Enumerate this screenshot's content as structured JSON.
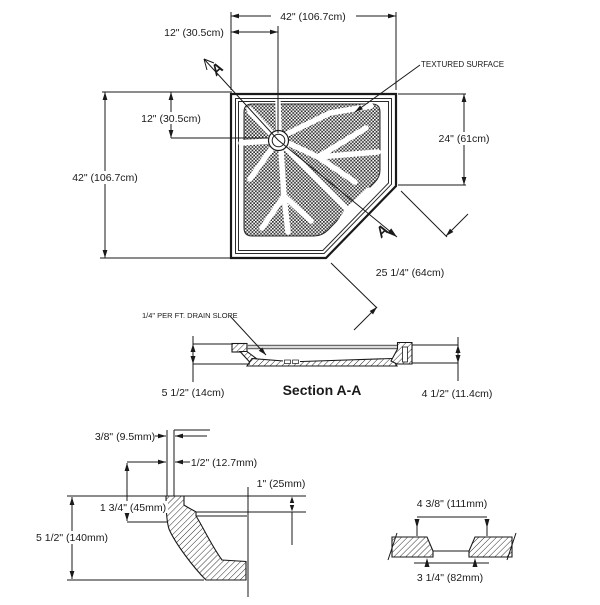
{
  "drawing": {
    "plan": {
      "dim_top_width": "42\" (106.7cm)",
      "dim_top_drain_offset": "12\" (30.5cm)",
      "dim_left_height": "42\" (106.7cm)",
      "dim_left_drain_offset": "12\" (30.5cm)",
      "dim_right_height": "24\" (61cm)",
      "dim_diagonal": "25 1/4\" (64cm)",
      "label_textured_surface": "TEXTURED SURFACE",
      "section_marker": "A"
    },
    "section": {
      "title": "Section A-A",
      "note_drain_slope": "1/4\" PER FT. DRAIN SLOPE",
      "dim_left_height": "5 1/2\" (14cm)",
      "dim_right_height": "4 1/2\" (11.4cm)"
    },
    "edge_detail": {
      "dim_lip_thickness": "3/8\" (9.5mm)",
      "dim_wall_thickness": "1/2\" (12.7mm)",
      "dim_ledge_depth": "1\" (25mm)",
      "dim_flange_height": "1 3/4\" (45mm)",
      "dim_overall_height": "5 1/2\" (140mm)"
    },
    "drain_detail": {
      "dim_outer_width": "4 3/8\" (111mm)",
      "dim_inner_width": "3 1/4\" (82mm)"
    },
    "colors": {
      "line": "#1a1a1a",
      "background": "#ffffff"
    }
  }
}
